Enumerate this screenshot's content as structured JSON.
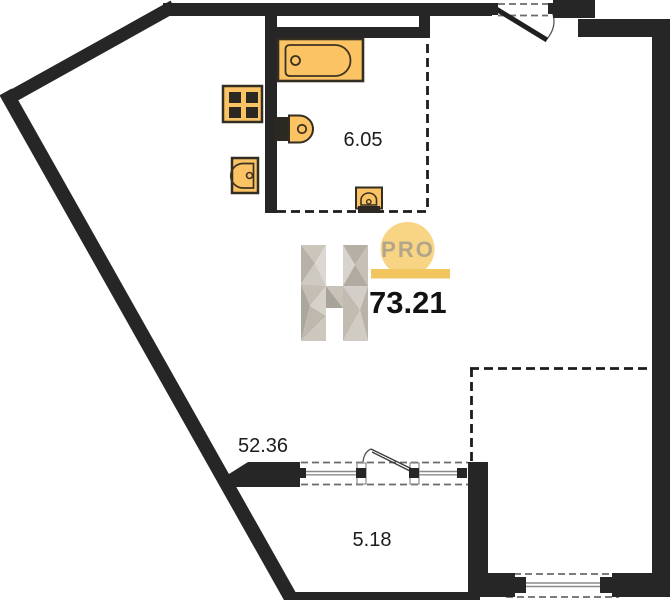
{
  "plan": {
    "title": "apartment-floor-plan",
    "total_area": "73.21",
    "rooms": [
      {
        "name": "bathroom",
        "area": "6.05"
      },
      {
        "name": "living-room",
        "area": "52.36"
      },
      {
        "name": "loggia",
        "area": "5.18"
      }
    ],
    "watermark": {
      "brand_letter": "H",
      "badge": "PRO"
    },
    "fixtures": [
      "bathtub-icon",
      "stove-icon",
      "toilet-icon",
      "kitchen-sink-icon",
      "washbasin-icon"
    ],
    "openings": [
      "entrance-door-swing",
      "interior-door-swing",
      "loggia-window",
      "balcony-window"
    ],
    "colors": {
      "wall": "#262626",
      "fixture_fill": "#fbc364",
      "fixture_stroke": "#332d22",
      "badge_circle": "#f8d584",
      "badge_bar": "#f3c55f",
      "badge_text": "#b3a58a",
      "area_text": "#1c1c1c"
    }
  }
}
